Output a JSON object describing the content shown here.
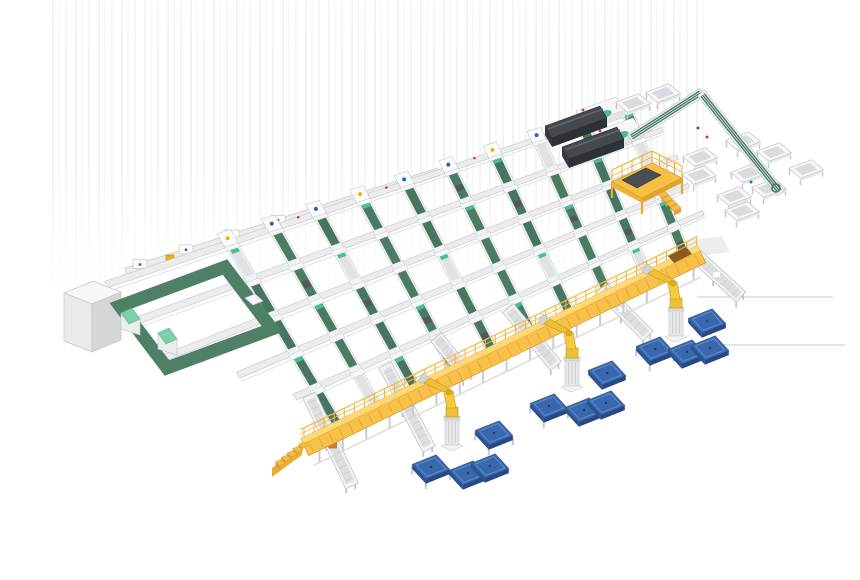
{
  "palette": {
    "background": "#ffffff",
    "belt_green": "#4a7b63",
    "belt_green_alt": "#467660",
    "loop_green": "#4e8068",
    "teal_accent": "#44c09a",
    "mint_top": "#7ed0ac",
    "frame_white": "#f2f3f4",
    "frame_fill": "#ececee",
    "frame_stroke": "#c3c6c9",
    "roller_gray": "#d9dbdd",
    "gantry_yellow": "#f7c14a",
    "gantry_deck": "#ffd978",
    "gantry_dark": "#dd9f2e",
    "gantry_rib": "#d6992c",
    "robot_yellow": "#ecc134",
    "robot_yellow_dark": "#c79a1f",
    "pallet_blue": "#3a68ae",
    "pallet_blue_light": "#5d8bc9",
    "pallet_blue_dark": "#27497f",
    "pallet_blue_mid": "#2c5191",
    "machine_dark": "#45484c",
    "machine_darker": "#2e3135",
    "machine_side": "#35383c",
    "red_accent": "#d23b2a",
    "blue_accent": "#2f5fd0",
    "yellow_accent": "#e8b40f",
    "tan_accent": "#c9813b",
    "shadow_gray": "#eeeeef",
    "faint_line": "#d4d5d6",
    "streak": "#94969a"
  },
  "inventory": {
    "sorter_lanes": 10,
    "sorter_cross_rails": 5,
    "induction_stations": 10,
    "infeed_stations": 4,
    "palletizing_robots": 3,
    "pallet_stacks": 12,
    "pallet_stands": 4,
    "outfeed_conveyors": 6,
    "packing_tables": 11,
    "dark_process_machines": 2,
    "machine_modules": 2,
    "operator_platforms": 1,
    "elevated_gantries": 1,
    "electrical_cabinets": 1,
    "buffer_loops": 1
  },
  "scene": {
    "grid": {
      "nw": [
        222,
        250
      ],
      "ne": [
        640,
        108
      ],
      "sw": [
        330,
        432
      ],
      "se": [
        697,
        253
      ],
      "lane_ts": [
        0.025,
        0.13,
        0.235,
        0.34,
        0.445,
        0.55,
        0.655,
        0.76,
        0.865,
        0.97
      ],
      "rows": [
        [
          -0.02,
          -0.27,
          1.02
        ],
        [
          0.18,
          -0.27,
          1.03
        ],
        [
          0.38,
          -0.25,
          1.04
        ],
        [
          0.58,
          -0.12,
          1.04
        ],
        [
          0.78,
          -0.03,
          1.05
        ]
      ],
      "belt_gaps": [
        [
          0.0,
          0.16
        ],
        [
          0.2,
          0.36
        ],
        [
          0.4,
          0.56
        ],
        [
          0.6,
          0.76
        ],
        [
          0.8,
          0.97
        ]
      ]
    },
    "infeed_line": {
      "from": [
        126,
        272
      ],
      "to": [
        438,
        172
      ],
      "stations_x": [
        140,
        186,
        232,
        278
      ],
      "yellow_box": [
        170,
        258
      ]
    },
    "left_cabinet": {
      "top": [
        [
          64,
          293
        ],
        [
          93,
          281
        ],
        [
          121,
          292
        ],
        [
          92,
          304
        ]
      ],
      "h": 48
    },
    "green_loop": {
      "ring": [
        [
          120,
          306
        ],
        [
          225,
          267
        ],
        [
          272,
          329
        ],
        [
          167,
          368
        ]
      ],
      "width": 13,
      "machines": [
        [
          131,
          311
        ],
        [
          168,
          331
        ]
      ],
      "white_box": [
        253,
        298
      ]
    },
    "dark_machines": [
      [
        545,
        126
      ],
      [
        562,
        147
      ]
    ],
    "machine_modules": [
      {
        "a": [
          576,
          111
        ],
        "teal": [
          605,
          114
        ],
        "red": [
          583,
          110
        ]
      },
      {
        "a": [
          593,
          132
        ],
        "teal": [
          622,
          135
        ],
        "red": [
          600,
          131
        ]
      }
    ],
    "right_conveyors": {
      "t1": [
        630,
        138,
        702,
        92
      ],
      "t2": [
        701,
        93,
        781,
        193
      ],
      "curl": [
        776,
        188
      ],
      "dots": [
        [
          707,
          137,
          "red"
        ],
        [
          698,
          128,
          "blue"
        ],
        [
          751,
          182,
          "blue"
        ]
      ]
    },
    "tables": [
      [
        633,
        103
      ],
      [
        663,
        93
      ],
      [
        700,
        157
      ],
      [
        699,
        175
      ],
      [
        743,
        141
      ],
      [
        774,
        152
      ],
      [
        806,
        169
      ],
      [
        748,
        173
      ],
      [
        734,
        196
      ],
      [
        769,
        188
      ],
      [
        742,
        211
      ]
    ],
    "platform": {
      "deck": [
        [
          612,
          182
        ],
        [
          652,
          163
        ],
        [
          682,
          178
        ],
        [
          642,
          198
        ]
      ],
      "chute": [
        [
          622,
          180
        ],
        [
          646,
          168
        ],
        [
          661,
          175
        ],
        [
          637,
          188
        ]
      ],
      "legs_h": 16,
      "rail_h": 12,
      "stairs_from": [
        658,
        194
      ]
    },
    "gantry": {
      "from": [
        303,
        444
      ],
      "to": [
        700,
        251
      ],
      "panel_w": 13,
      "deck_w": 6,
      "rail_h": 9,
      "end_cap": [
        [
          668,
          256
        ],
        [
          686,
          247
        ],
        [
          692,
          254
        ],
        [
          674,
          263
        ]
      ]
    },
    "shadow_quad": [
      [
        677,
        242
      ],
      [
        722,
        236
      ],
      [
        730,
        252
      ],
      [
        685,
        258
      ]
    ],
    "outfeed_lanes": [
      [
        309,
        395,
        352,
        486
      ],
      [
        385,
        365,
        429,
        449
      ],
      [
        436,
        337,
        468,
        376
      ],
      [
        508,
        308,
        556,
        366
      ],
      [
        601,
        288,
        648,
        336
      ],
      [
        692,
        252,
        741,
        297
      ]
    ],
    "outfeed_items": [
      [
        0,
        0.55,
        "tan"
      ],
      [
        1,
        0.45,
        "white"
      ],
      [
        3,
        0.5,
        "tan"
      ],
      [
        4,
        0.45,
        "white"
      ],
      [
        5,
        0.5,
        "white"
      ]
    ],
    "robots": [
      [
        676,
        336
      ],
      [
        572,
        386
      ],
      [
        452,
        445
      ]
    ],
    "pallets": [
      {
        "c": [
          707,
          321
        ]
      },
      {
        "c": [
          655,
          349
        ],
        "stand": true
      },
      {
        "c": [
          687,
          352
        ]
      },
      {
        "c": [
          710,
          348
        ]
      },
      {
        "c": [
          607,
          373
        ]
      },
      {
        "c": [
          549,
          406
        ],
        "stand": true
      },
      {
        "c": [
          584,
          410
        ]
      },
      {
        "c": [
          606,
          403
        ]
      },
      {
        "c": [
          494,
          433
        ],
        "stand": true
      },
      {
        "c": [
          431,
          467
        ],
        "stand": true
      },
      {
        "c": [
          468,
          473
        ]
      },
      {
        "c": [
          490,
          466
        ]
      }
    ],
    "faint_lines": [
      [
        697,
        297,
        833,
        297
      ],
      [
        717,
        345,
        845,
        345
      ]
    ]
  }
}
